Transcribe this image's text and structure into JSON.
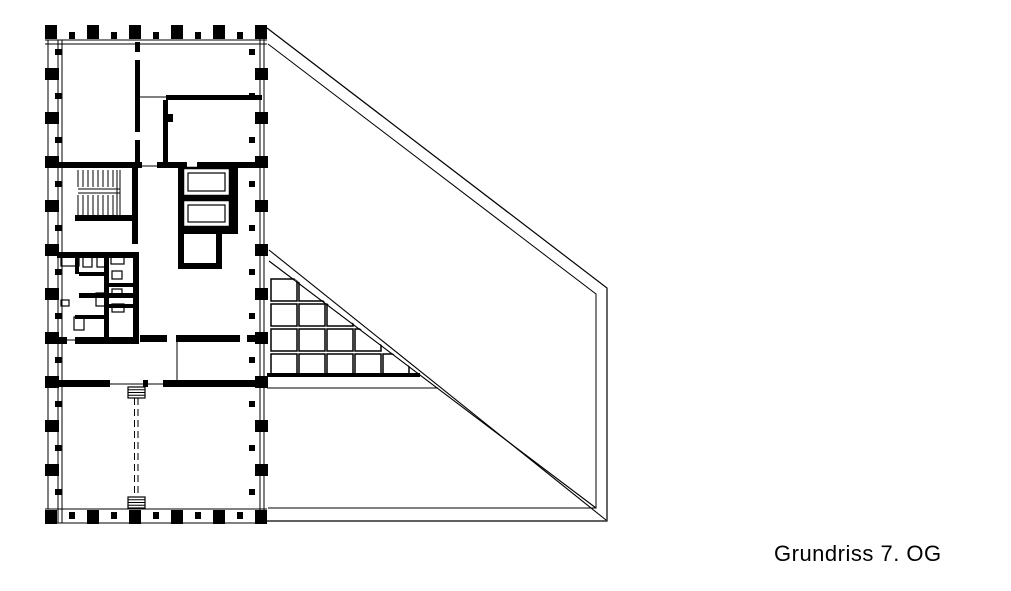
{
  "caption": "Grundriss 7. OG",
  "colors": {
    "ink": "#000000",
    "paper": "#ffffff"
  },
  "plan": {
    "canvas": {
      "w": 1011,
      "h": 591
    },
    "terrace": {
      "outer": [
        [
          267,
          28
        ],
        [
          607,
          288
        ],
        [
          607,
          521
        ],
        [
          267,
          521
        ]
      ],
      "inner": [
        [
          268,
          44
        ],
        [
          596,
          294
        ],
        [
          596,
          508
        ],
        [
          268,
          508
        ]
      ],
      "diagA": [
        269,
        250,
        606,
        520
      ],
      "diagB": [
        269,
        261,
        596,
        508
      ],
      "triBottom": [
        267,
        373,
        153,
        4
      ],
      "midLine": [
        267,
        388,
        438,
        388
      ]
    },
    "grid": {
      "x0": 271,
      "y0": 279,
      "cw": 26,
      "ch": 22,
      "sx": 28,
      "sy": 25,
      "rows": [
        2,
        3,
        4,
        5
      ],
      "mask": [
        [
          269,
          259
        ],
        [
          598,
          510
        ],
        [
          940,
          510
        ],
        [
          940,
          259
        ]
      ]
    },
    "walls": [
      [
        135,
        42,
        5,
        10
      ],
      [
        135,
        60,
        5,
        72
      ],
      [
        135,
        140,
        5,
        22
      ],
      [
        166,
        95,
        96,
        5
      ],
      [
        163,
        100,
        5,
        62
      ],
      [
        168,
        114,
        5,
        8
      ],
      [
        57,
        162,
        85,
        6
      ],
      [
        157,
        162,
        30,
        6
      ],
      [
        197,
        162,
        65,
        6
      ],
      [
        132,
        168,
        6,
        76
      ],
      [
        75,
        215,
        62,
        6
      ],
      [
        178,
        168,
        5,
        60
      ],
      [
        183,
        196,
        47,
        4
      ],
      [
        230,
        168,
        8,
        60
      ],
      [
        178,
        228,
        60,
        6
      ],
      [
        178,
        234,
        6,
        35
      ],
      [
        178,
        263,
        44,
        6
      ],
      [
        216,
        234,
        6,
        35
      ],
      [
        57,
        252,
        82,
        6
      ],
      [
        133,
        258,
        6,
        86
      ],
      [
        75,
        258,
        4,
        16
      ],
      [
        104,
        252,
        5,
        52
      ],
      [
        79,
        272,
        25,
        4
      ],
      [
        108,
        283,
        25,
        4
      ],
      [
        79,
        293,
        54,
        5
      ],
      [
        108,
        304,
        25,
        4
      ],
      [
        104,
        304,
        5,
        40
      ],
      [
        75,
        315,
        33,
        4
      ],
      [
        57,
        337,
        10,
        7
      ],
      [
        75,
        337,
        64,
        7
      ],
      [
        140,
        335,
        27,
        7
      ],
      [
        176,
        335,
        64,
        7
      ],
      [
        247,
        335,
        15,
        7
      ],
      [
        57,
        380,
        53,
        7
      ],
      [
        143,
        380,
        5,
        7
      ],
      [
        163,
        380,
        104,
        7
      ]
    ],
    "thin": [
      [
        140,
        97,
        166,
        97
      ],
      [
        142,
        166,
        158,
        166
      ],
      [
        177,
        342,
        177,
        380
      ],
      [
        48,
        40,
        48,
        509
      ],
      [
        110,
        384,
        143,
        384
      ],
      [
        147,
        384,
        163,
        384
      ],
      [
        65,
        340,
        75,
        340
      ]
    ],
    "facades": {
      "top": {
        "lines": [
          [
            45,
            40,
            267,
            40
          ],
          [
            45,
            44,
            267,
            44
          ]
        ],
        "large": {
          "y": 25,
          "w": 12,
          "h": 14,
          "cx": [
            51,
            93,
            135,
            177,
            219,
            261
          ]
        },
        "small": {
          "y": 32,
          "w": 6,
          "h": 7,
          "cx": [
            72,
            114,
            156,
            198,
            240
          ]
        }
      },
      "bottom": {
        "lines": [
          [
            45,
            509,
            267,
            509
          ],
          [
            45,
            523,
            267,
            523
          ]
        ],
        "large": {
          "y": 510,
          "w": 12,
          "h": 14,
          "cx": [
            51,
            93,
            135,
            177,
            219,
            261
          ]
        },
        "small": {
          "y": 512,
          "w": 6,
          "h": 7,
          "cx": [
            72,
            114,
            156,
            198,
            240
          ]
        }
      },
      "left": {
        "lines": [
          [
            58,
            40,
            58,
            523
          ],
          [
            62,
            40,
            62,
            523
          ]
        ],
        "large": {
          "x": 45,
          "w": 14,
          "h": 12,
          "cy": [
            74,
            118,
            162,
            206,
            250,
            294,
            338,
            382,
            426,
            470
          ]
        },
        "small": {
          "x": 55,
          "w": 7,
          "h": 6,
          "cy": [
            52,
            96,
            140,
            184,
            228,
            272,
            316,
            360,
            404,
            448,
            492
          ]
        }
      },
      "right": {
        "lines": [
          [
            260,
            28,
            260,
            523
          ],
          [
            264,
            28,
            264,
            523
          ]
        ],
        "large": {
          "x": 255,
          "w": 13,
          "h": 12,
          "cy": [
            74,
            118,
            162,
            206,
            250,
            294,
            338,
            382,
            426,
            470
          ]
        },
        "small": {
          "x": 249,
          "w": 6,
          "h": 6,
          "cy": [
            52,
            96,
            140,
            184,
            228,
            272,
            316,
            360,
            404,
            448,
            492
          ]
        }
      }
    },
    "stairs": {
      "x": 78,
      "xe": 113,
      "n": 8,
      "y1": 170,
      "y2": 187,
      "landing": [
        189,
        193
      ],
      "y3": 195,
      "y4": 215,
      "well": [
        117,
        120
      ]
    },
    "elevators": [
      {
        "outer": [
          183,
          168,
          47,
          28
        ],
        "inner": [
          188,
          173,
          37,
          18
        ]
      },
      {
        "outer": [
          183,
          200,
          47,
          27
        ],
        "inner": [
          188,
          205,
          37,
          17
        ]
      }
    ],
    "fixtures": [
      [
        61,
        257,
        18,
        9
      ],
      [
        83,
        256,
        9,
        11
      ],
      [
        97,
        256,
        9,
        11
      ],
      [
        111,
        256,
        13,
        8
      ],
      [
        112,
        271,
        10,
        8
      ],
      [
        112,
        289,
        10,
        8
      ],
      [
        96,
        293,
        11,
        13
      ],
      [
        112,
        304,
        12,
        8
      ],
      [
        74,
        317,
        10,
        13
      ],
      [
        61,
        300,
        8,
        6
      ]
    ],
    "partition": {
      "x1": 134.5,
      "x2": 138,
      "y1": 398,
      "y2": 498,
      "blocks": [
        [
          128,
          387,
          17,
          11
        ],
        [
          128,
          497,
          17,
          11
        ]
      ]
    }
  }
}
